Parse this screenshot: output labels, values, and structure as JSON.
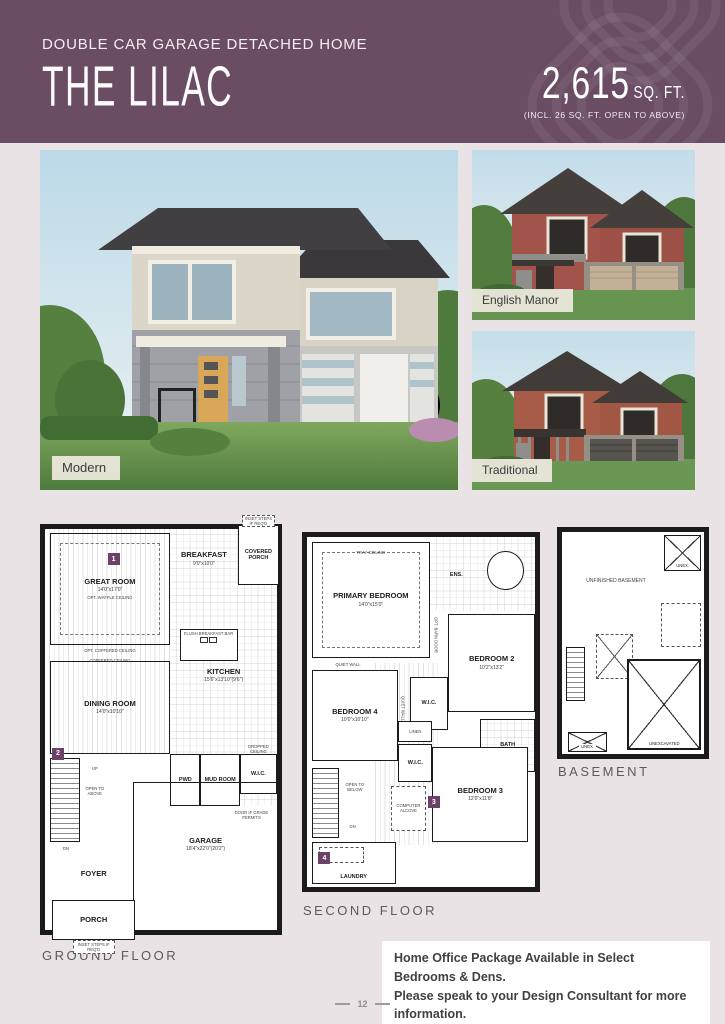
{
  "header": {
    "subtitle": "DOUBLE CAR GARAGE DETACHED HOME",
    "title": "THE LILAC",
    "sqft_value": "2,615",
    "sqft_unit": "SQ. FT.",
    "sqft_note": "(INCL. 26 SQ. FT. OPEN TO ABOVE)",
    "bg_color": "#6a4c63"
  },
  "photos": {
    "modern_label": "Modern",
    "english_manor_label": "English Manor",
    "traditional_label": "Traditional"
  },
  "floorplans": {
    "ground": {
      "label": "GROUND FLOOR",
      "markers": [
        "1",
        "2"
      ],
      "rooms": {
        "great_room": {
          "name": "GREAT ROOM",
          "dims": "14'0\"x17'0\""
        },
        "dining_room": {
          "name": "DINING ROOM",
          "dims": "14'0\"x10'10\""
        },
        "breakfast": {
          "name": "BREAKFAST",
          "dims": "9'0\"x10'0\""
        },
        "kitchen": {
          "name": "KITCHEN",
          "dims": "15'6\"x13'10\"(9'6\")"
        },
        "covered_porch": {
          "name": "COVERED PORCH"
        },
        "pwd": {
          "name": "PWD"
        },
        "mud_room": {
          "name": "MUD ROOM"
        },
        "wic": {
          "name": "W.I.C."
        },
        "foyer": {
          "name": "FOYER"
        },
        "garage": {
          "name": "GARAGE",
          "dims": "18'4\"x22'0\"(20'2\")"
        },
        "porch": {
          "name": "PORCH"
        }
      },
      "annotations": {
        "waffle": "OPT. WAFFLE CEILING",
        "opt_coffered": "OPT. COFFERED CEILING",
        "coffered": "COFFERED CEILING",
        "breakfast_bar": "FLUSH BREAKFAST BAR",
        "open_above": "OPEN TO ABOVE",
        "up": "UP",
        "dn": "DN",
        "dropped": "DROPPED CEILING",
        "grade_door": "DOOR IF GRADE PERMITS",
        "inset_steps": "INSET STEPS IF REQ'D"
      }
    },
    "second": {
      "label": "SECOND FLOOR",
      "markers": [
        "3",
        "4"
      ],
      "rooms": {
        "primary_bedroom": {
          "name": "PRIMARY BEDROOM",
          "dims": "14'0\"x15'0\""
        },
        "ensuite": {
          "name": "ENS."
        },
        "bedroom2": {
          "name": "BEDROOM 2",
          "dims": "10'2\"x13'2\""
        },
        "bedroom3": {
          "name": "BEDROOM 3",
          "dims": "12'0\"x11'8\""
        },
        "bedroom4": {
          "name": "BEDROOM 4",
          "dims": "10'0\"x10'10\""
        },
        "wic_primary": {
          "name": "W.I.C."
        },
        "wic2": {
          "name": "W.I.C."
        },
        "bath": {
          "name": "BATH"
        },
        "linen": {
          "name": "LINEN"
        },
        "laundry": {
          "name": "LAUNDRY"
        }
      },
      "annotations": {
        "tray": "TRAY CEILING",
        "quiet_wall": "QUIET WALL",
        "barn_door": "OPT. BARN DOOR",
        "open_below": "OPEN TO BELOW",
        "computer_alcove": "COMPUTER ALCOVE",
        "dn": "DN"
      }
    },
    "basement": {
      "label": "BASEMENT",
      "rooms": {
        "unfinished": {
          "name": "UNFINISHED BASEMENT"
        },
        "unexcavated": {
          "name": "UNEXCAVATED"
        },
        "unex1": {
          "name": "UNEX."
        },
        "unex2": {
          "name": "UNEX."
        }
      }
    }
  },
  "note": {
    "line1": "Home Office Package Available in Select Bedrooms & Dens.",
    "line2": "Please speak to your Design Consultant for more information."
  },
  "page": {
    "number": "12"
  }
}
